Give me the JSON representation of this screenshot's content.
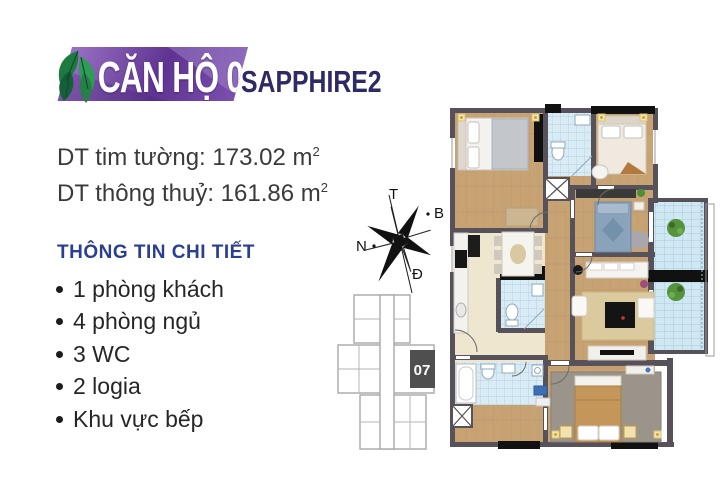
{
  "header": {
    "unit_title": "CĂN HỘ 07",
    "project_name": "SAPPHIRE2"
  },
  "areas": {
    "gross_line": "DT tim tường: 173.02 m",
    "net_line": "DT thông thuỷ: 161.86 m",
    "sup": "2"
  },
  "details": {
    "heading": "THÔNG TIN CHI TIẾT",
    "items": [
      "1 phòng khách",
      "4 phòng ngủ",
      "3 WC",
      "2 logia",
      "Khu vực bếp"
    ]
  },
  "compass": {
    "top": "T",
    "right": "B",
    "left": "N",
    "bottom": "Đ"
  },
  "keyplan": {
    "unit_label": "07"
  },
  "icons": [
    "leaf-icon",
    "compass-rose-icon"
  ],
  "colors": {
    "banner_a": "#9a72c4",
    "banner_b": "#5e3391",
    "banner_c": "#7b4fae",
    "navy": "#2e2a66",
    "heading": "#2b3f92",
    "text": "#3a3a3a",
    "wall": "#57525a",
    "wood": "#c7a273",
    "cream": "#efe6d0",
    "tile": "#d9ebf5",
    "balcony": "#cfe8f3",
    "leaf": "#2e9b57",
    "keyplan": "#4f4f4f"
  }
}
